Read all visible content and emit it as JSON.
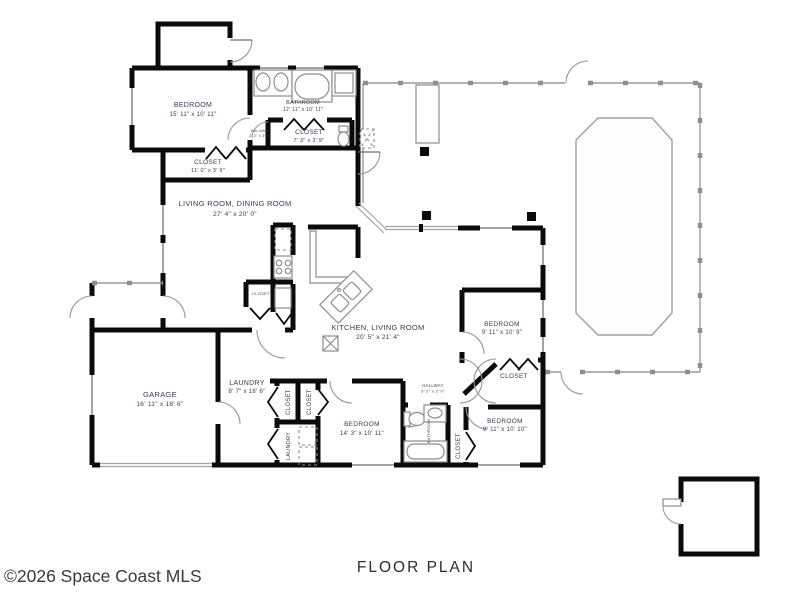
{
  "rooms": {
    "bedroom1": {
      "name": "BEDROOM",
      "dims": "15' 11\" x 10' 11\""
    },
    "bathroom1": {
      "name": "BATHROOM",
      "dims": "12' 11\" x 10' 11\""
    },
    "closet_bath": {
      "name": "CLOSET",
      "dims": "7' 3\" x 3' 9\""
    },
    "hall_small": {
      "name": "HALLWAY",
      "dims": "2' 2\" x 3' 9\""
    },
    "closet_bed1": {
      "name": "CLOSET",
      "dims": "11' 0\" x 3' 9\""
    },
    "living_dining": {
      "name": "LIVING ROOM, DINING ROOM",
      "dims": "27' 4\" x 20' 0\""
    },
    "kitchen_living": {
      "name": "KITCHEN, LIVING ROOM",
      "dims": "20' 5\" x 21' 4\""
    },
    "bedroom2": {
      "name": "BEDROOM",
      "dims": "9' 11\" x 10' 9\""
    },
    "closet_bed2": {
      "name": "CLOSET"
    },
    "hallway": {
      "name": "HALLWAY",
      "dims": "6' 2\" x 2' 0\""
    },
    "bedroom3": {
      "name": "BEDROOM",
      "dims": "9' 11\" x 10' 10\""
    },
    "closet_bed3": {
      "name": "CLOSET"
    },
    "bathroom2": {
      "name": "BATHROOM"
    },
    "bedroom4": {
      "name": "BEDROOM",
      "dims": "14' 3\" x 10' 11\""
    },
    "closet_a": {
      "name": "CLOSET"
    },
    "closet_b": {
      "name": "CLOSET"
    },
    "laundry_closet": {
      "name": "LAUNDRY"
    },
    "closet_kitchen": {
      "name": "CLOSET"
    },
    "laundry": {
      "name": "LAUNDRY",
      "dims": "8' 7\" x 18' 6\""
    },
    "garage": {
      "name": "GARAGE",
      "dims": "16' 11\" x 18' 6\""
    }
  },
  "footer": {
    "copyright": "©2026 Space Coast MLS",
    "title": "FLOOR PLAN"
  },
  "colors": {
    "wall": "#0b0b0b",
    "screen": "#9a9a9a",
    "label": "#3a3a55"
  }
}
